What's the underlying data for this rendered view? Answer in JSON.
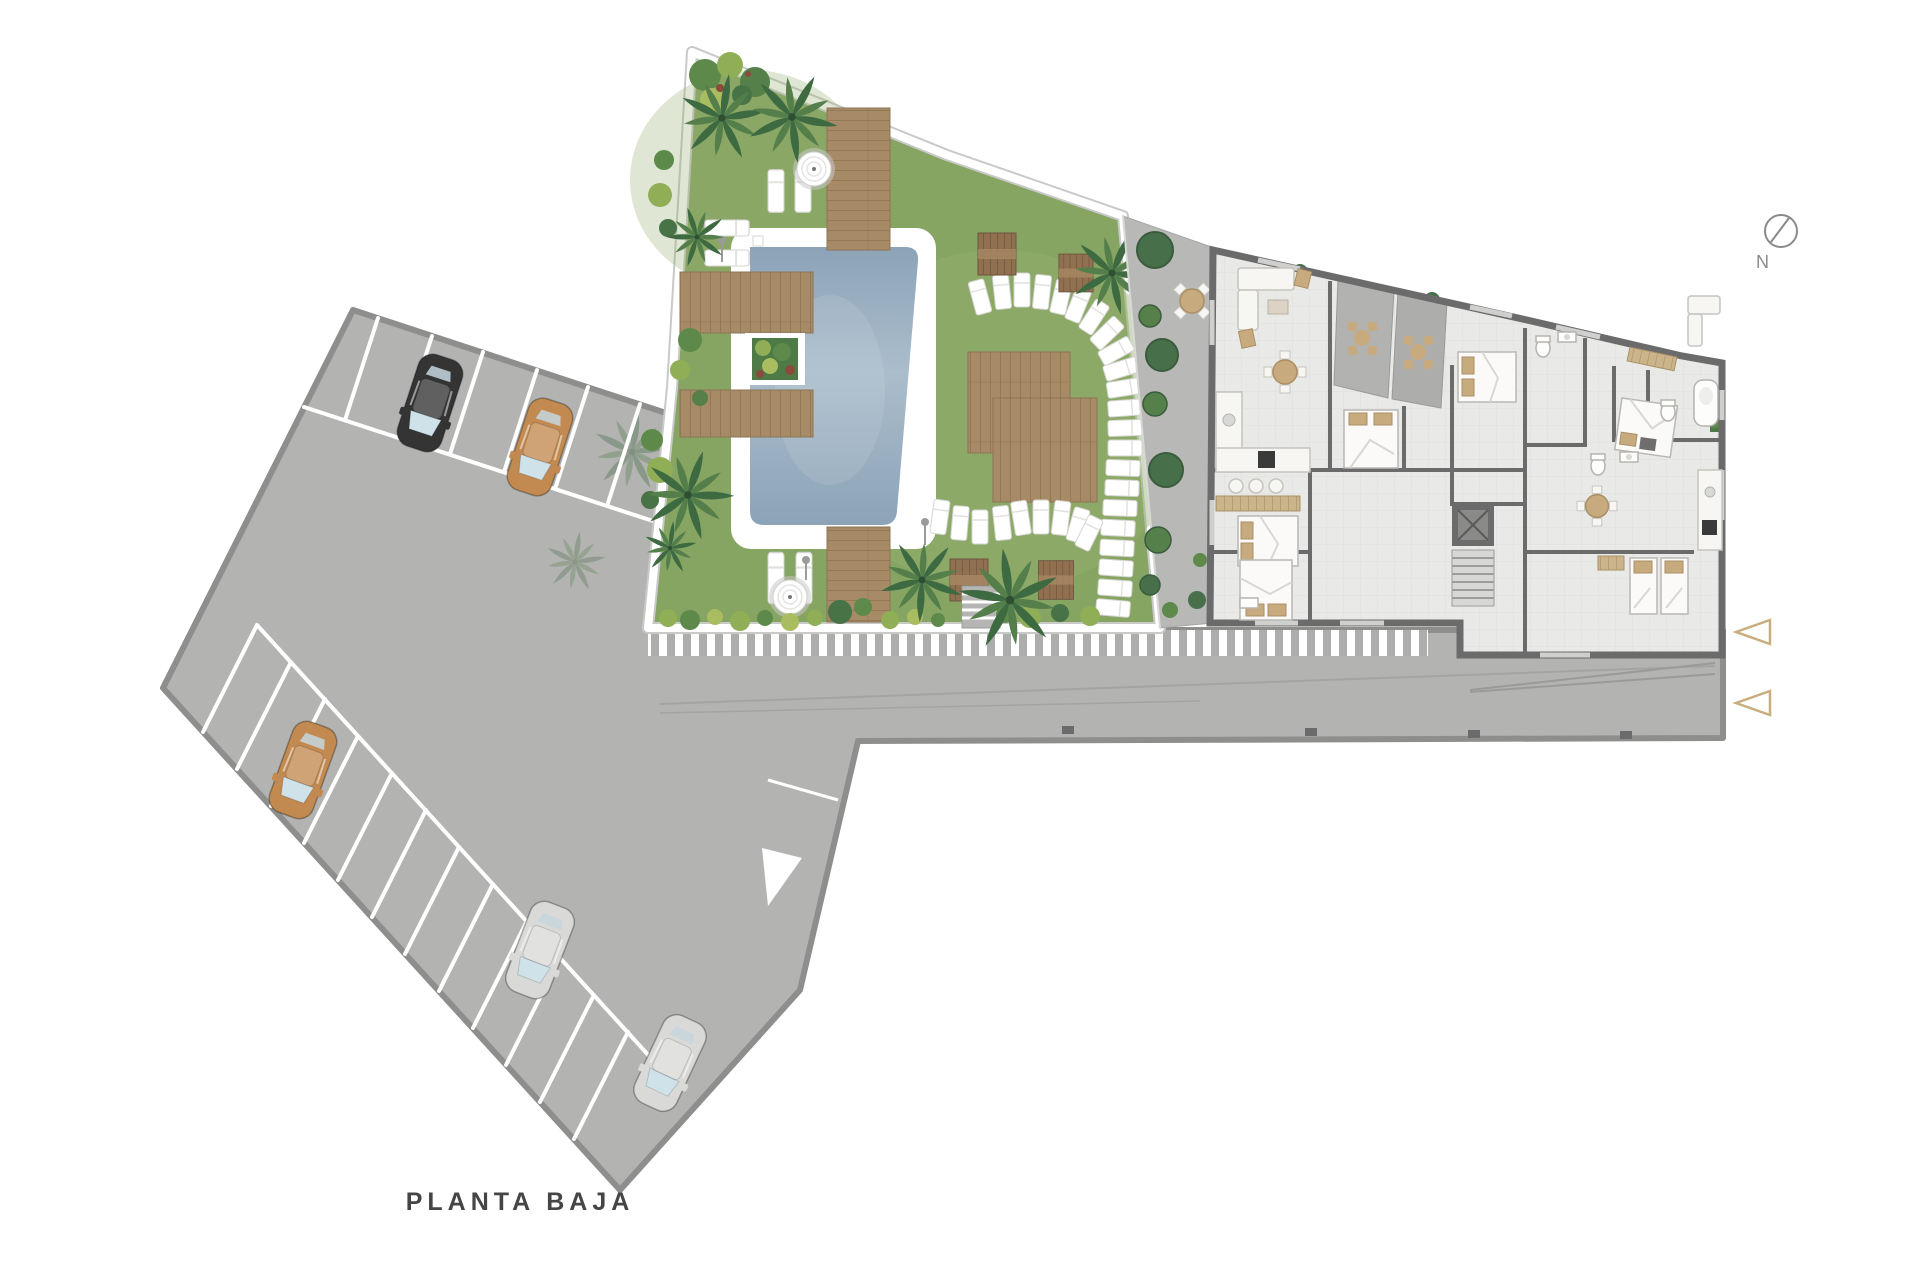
{
  "labels": {
    "title": "PLANTA BAJA",
    "compass_north": "N"
  },
  "colors": {
    "background": "#ffffff",
    "pavement": "#b3b3b1",
    "pavementEdge": "#8e8e8c",
    "stallLine": "#ffffff",
    "grass": "#86a462",
    "grassLight": "#95b070",
    "water": "#8ca3b8",
    "waterLight": "#aabdcb",
    "poolSurround": "#ffffff",
    "wood": "#a68b66",
    "woodLine": "#8c7152",
    "path": "#b8b8b6",
    "wall": "#6b6b6b",
    "floor": "#e9e9e7",
    "terrace": "#b2b2b0",
    "furnitureWhite": "#f7f6f3",
    "furnitureTan": "#c7ab7e",
    "palm1": "#3e6a42",
    "palm2": "#547f4b",
    "bush1": "#5d8a4b",
    "bush2": "#8fae56",
    "bush3": "#a9bd60",
    "accent": "#c9ae7d",
    "carBlack": "#343434",
    "carTan": "#c28a50",
    "carSilver": "#d9d9d8",
    "text": "#454545",
    "compass": "#8a8a8a"
  }
}
